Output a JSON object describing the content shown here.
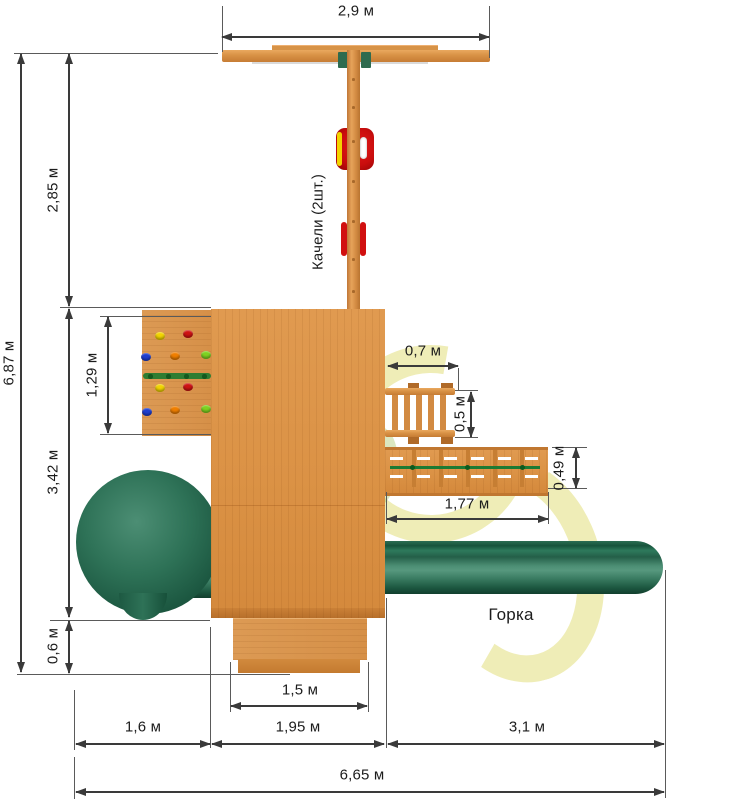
{
  "drawing": {
    "type": "playground-top-view-blueprint",
    "labels": {
      "swings": "Качели (2шт.)",
      "slide": "Горка"
    },
    "dimensions": {
      "top_width": "2,9 м",
      "left_upper": "2,85 м",
      "total_height": "6,87 м",
      "climb_wall": "1,29 м",
      "left_mid": "3,42 м",
      "left_lower": "0,6 м",
      "ladder_len": "0,7 м",
      "ladder_wid": "0,5 м",
      "bridge_wid": "0,49 м",
      "bridge_len": "1,77 м",
      "steps_wid": "1,5 м",
      "bottom_left": "1,6 м",
      "bottom_mid": "1,95 м",
      "bottom_right": "3,1 м",
      "total_width": "6,65 м"
    },
    "colors": {
      "dim_line": "#3a3a3a",
      "wood": "#dd9449",
      "wood_dark": "#c07a31",
      "wood_light": "#e8a55c",
      "slide_green": "#2e7257",
      "slide_green_dark": "#17503a",
      "slide_green_light": "#57987e",
      "rope_green": "#1c7a33",
      "bracket_green": "#2f6b4f",
      "seat_red": "#d11010",
      "seat_yellow": "#f2d400",
      "watermark_yellow": "#d7d24b",
      "watermark_green": "#96b946"
    },
    "hold_colors": {
      "yellow": "#f2d400",
      "red": "#cf1313",
      "blue": "#1f3fd0",
      "orange": "#f07f00",
      "lime": "#7ed321"
    }
  }
}
